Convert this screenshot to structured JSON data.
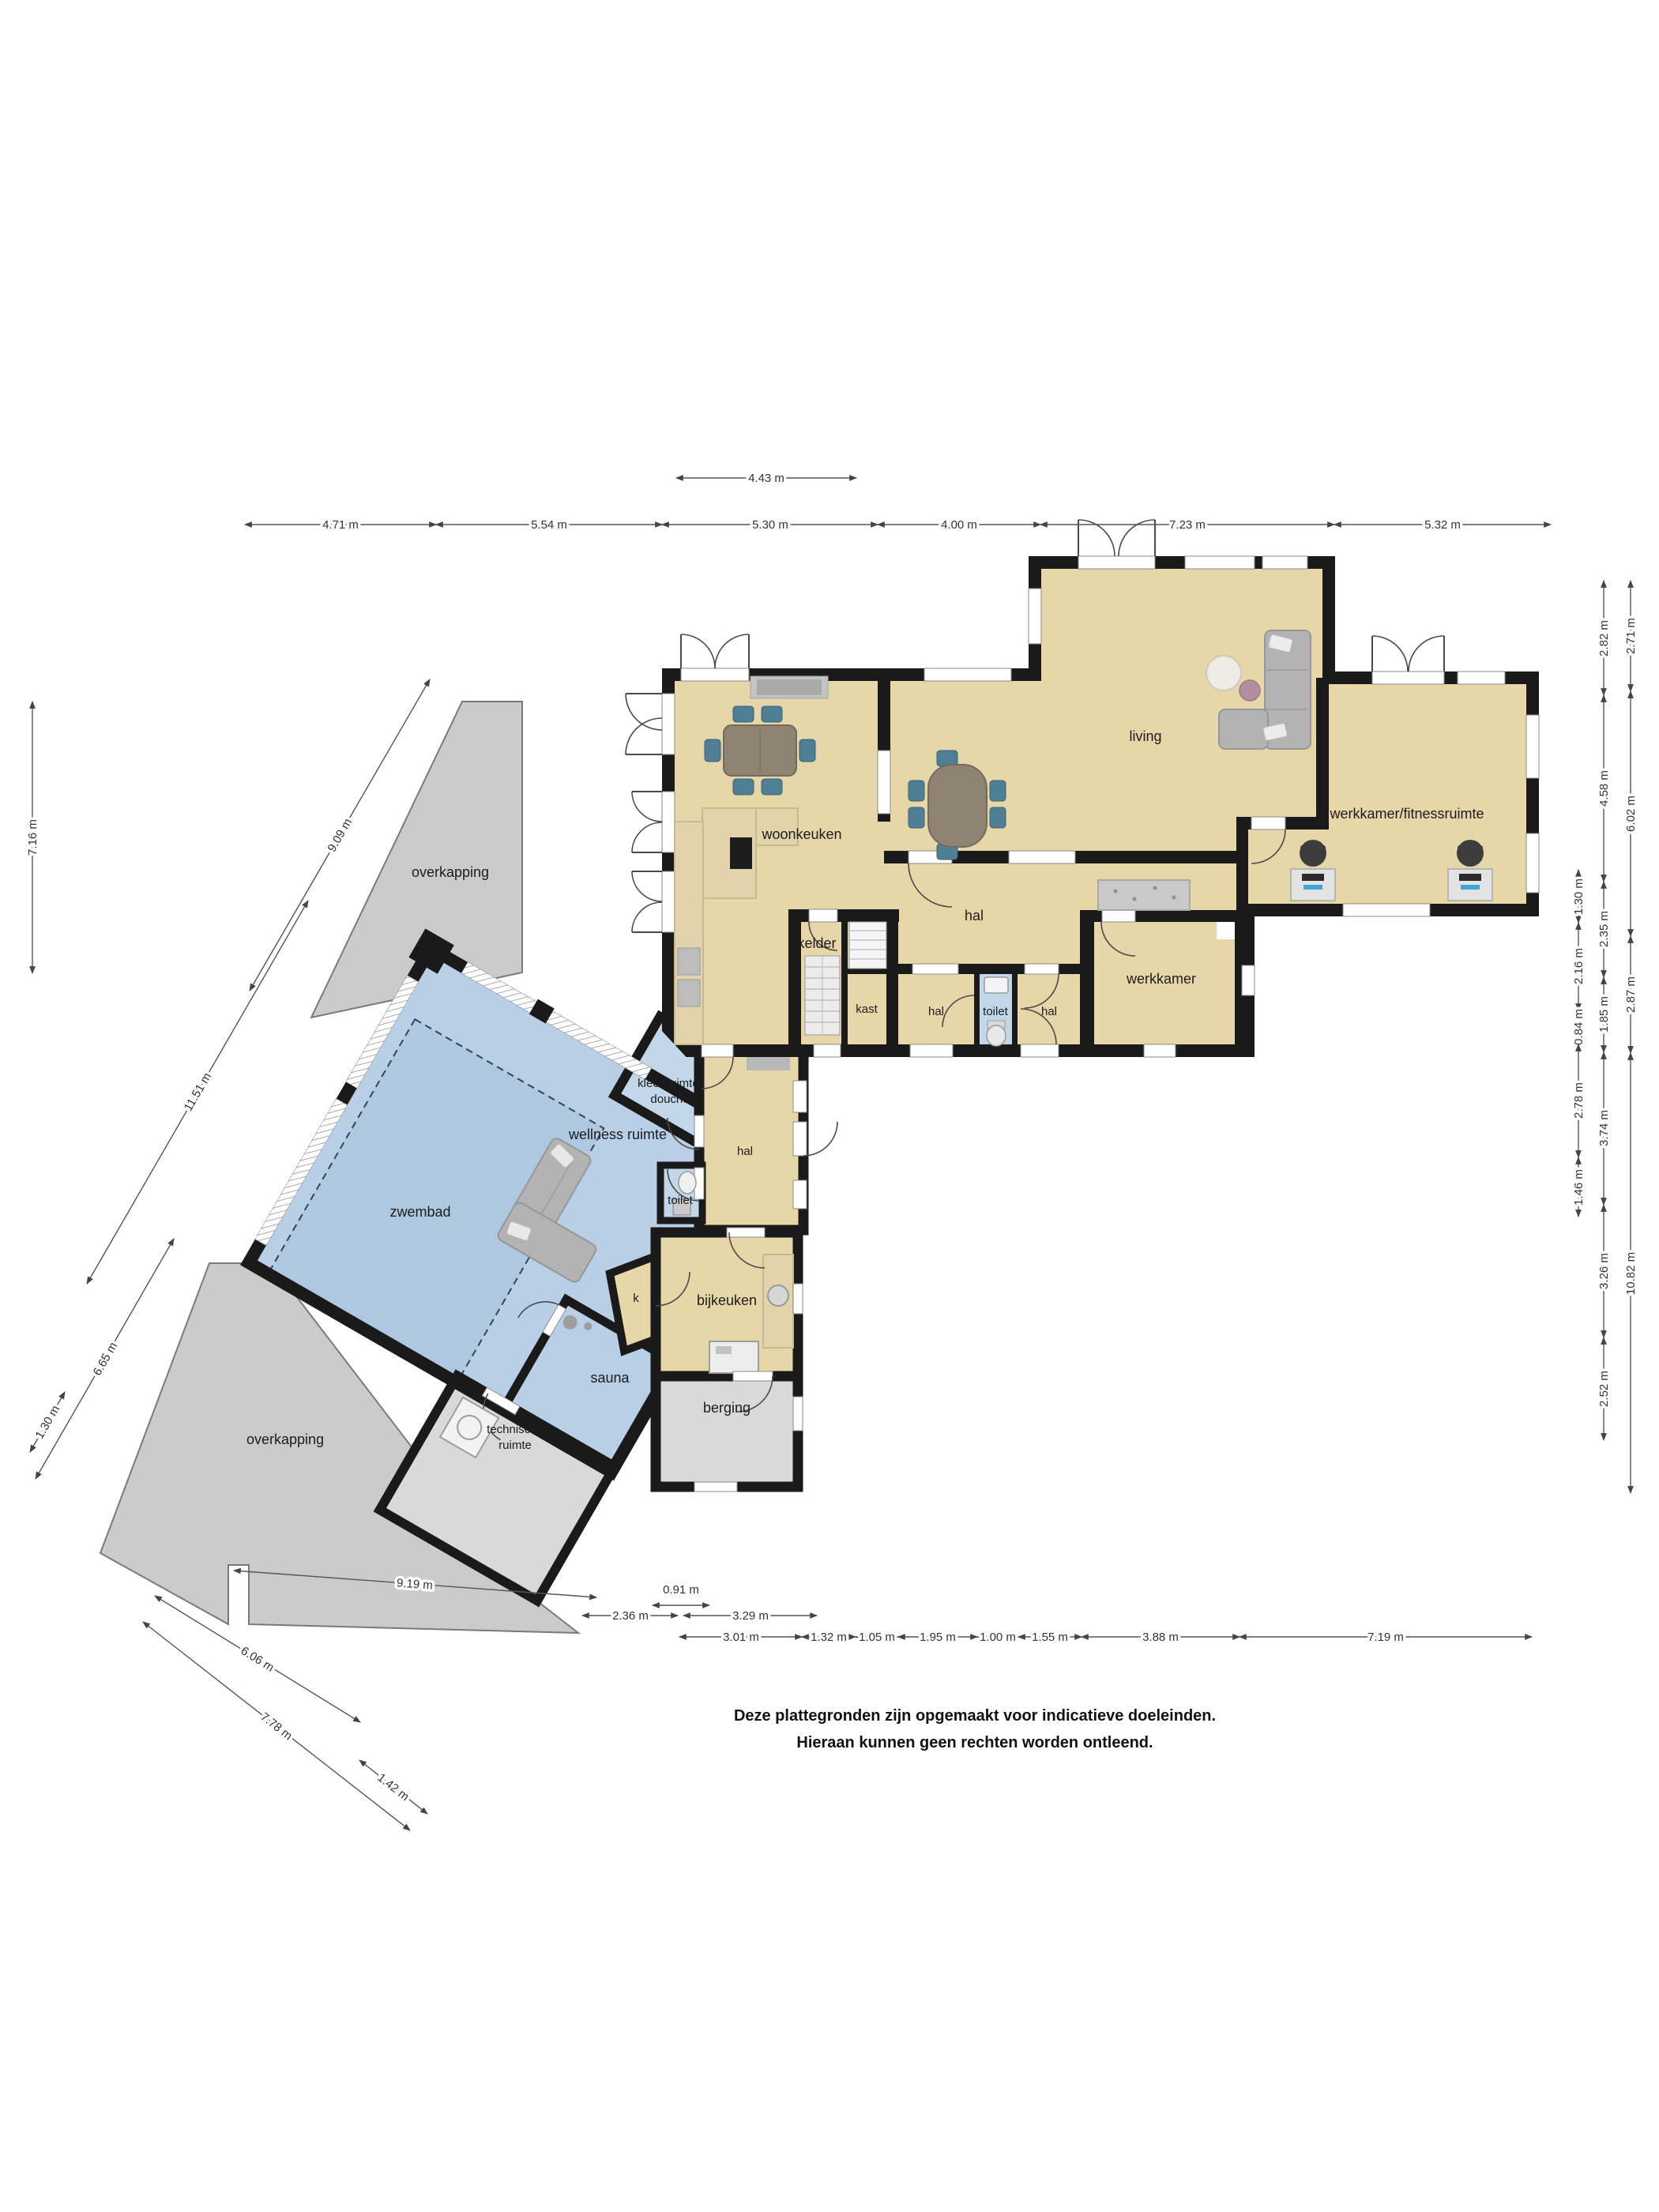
{
  "plan_title": "begane grond plattegrond",
  "rooms": {
    "living": "living",
    "woonkeuken": "woonkeuken",
    "werkkamer_fitness": "werkkamer/fitnessruimte",
    "hal_main": "hal",
    "kelder": "kelder",
    "kast": "kast",
    "hal_band_left": "hal",
    "toilet_main": "toilet",
    "hal_band_right": "hal",
    "werkkamer": "werkkamer",
    "zwembad": "zwembad",
    "wellness": "wellness ruimte",
    "kleedruimte_line1": "kleedruimte/",
    "kleedruimte_line2": "douche",
    "toilet_wing": "toilet",
    "hal_wing": "hal",
    "k": "k",
    "bijkeuken": "bijkeuken",
    "sauna": "sauna",
    "technische_line1": "technische",
    "technische_line2": "ruimte",
    "berging": "berging",
    "overkapping_top": "overkapping",
    "overkapping_bottom": "overkapping"
  },
  "dims": {
    "top1": [
      "4.43 m"
    ],
    "top2": [
      "4.71 m",
      "5.54 m",
      "5.30 m",
      "4.00 m",
      "7.23 m",
      "5.32 m"
    ],
    "right_inner": [
      "1.30 m",
      "2.16 m",
      "0.84 m",
      "2.78 m",
      "1.46 m"
    ],
    "right_mid": [
      "2.82 m",
      "4.58 m",
      "2.35 m",
      "1.85 m",
      "3.74 m",
      "3.26 m",
      "2.52 m"
    ],
    "right_outer": [
      "2.71 m",
      "6.02 m",
      "2.87 m",
      "10.82 m"
    ],
    "left": [
      "7.16 m"
    ],
    "diag_upper": [
      "9.09 m",
      "11.51 m"
    ],
    "diag_lower": [
      "6.65 m",
      "1.30 m",
      "6.06 m",
      "7.78 m",
      "1.42 m"
    ],
    "bottom_row1": [
      "9.19 m",
      "0.91 m"
    ],
    "bottom_row2": [
      "2.36 m",
      "3.29 m"
    ],
    "bottom_row3": [
      "3.01 m",
      "1.32 m",
      "1.05 m",
      "1.95 m",
      "1.00 m",
      "1.55 m",
      "3.88 m",
      "7.19 m"
    ]
  },
  "disclaimer": {
    "line1": "Deze plattegronden zijn opgemaakt voor indicatieve doeleinden.",
    "line2": "Hieraan kunnen geen rechten worden ontleend."
  },
  "colors": {
    "floor_tan": "#e7d6a8",
    "floor_blue": "#b9cfe6",
    "floor_blue_light": "#c3d7ea",
    "floor_gray": "#d9d9d9",
    "wall_black": "#1a1a1a",
    "overkapping_gray": "#cbcbcb",
    "chair_blue": "#4e7f95",
    "wood": "#8f8474",
    "sofa_gray": "#b3b3b3"
  }
}
